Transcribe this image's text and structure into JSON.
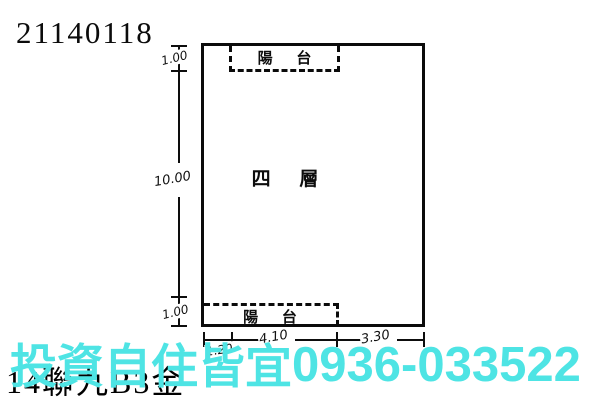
{
  "document": {
    "id_number": "21140118",
    "background_code": "14聯九B3金"
  },
  "floor_plan": {
    "floor_label": "四 層",
    "balcony_top_label": "陽 台",
    "balcony_bottom_label": "陽 台",
    "dims_left": [
      "1.00",
      "10.00",
      "1.00"
    ],
    "dims_bottom": [
      "1.20",
      "4.10",
      "3.30"
    ]
  },
  "watermark": {
    "text": "投資自住皆宜",
    "phone": "0936-033522",
    "color": "#4ee4e4"
  },
  "colors": {
    "line": "#0b0b0b",
    "background": "#ffffff"
  }
}
